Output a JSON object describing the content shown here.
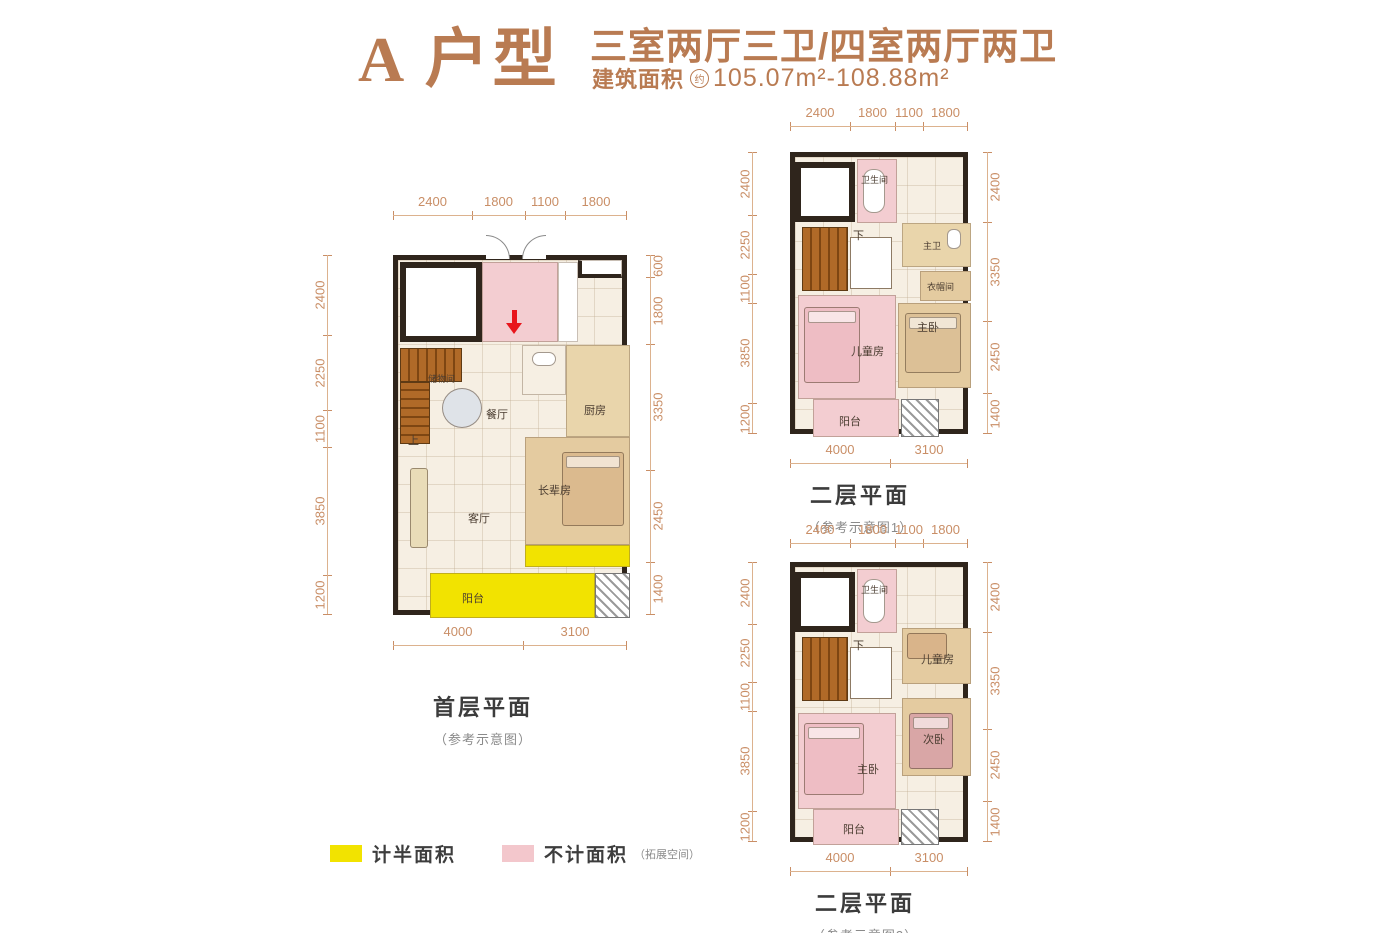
{
  "header": {
    "title": "A 户型",
    "subtitle": "三室两厅三卫/四室两厅两卫",
    "area_label": "建筑面积",
    "area_approx": "约",
    "area_value": "105.07m²-108.88m²"
  },
  "legend": {
    "half": {
      "label": "计半面积",
      "color": "#f2e300"
    },
    "none": {
      "label": "不计面积",
      "note": "（拓展空间）",
      "color": "#f3c7cc"
    }
  },
  "plans": [
    {
      "caption": "首层平面",
      "note": "（参考示意图）",
      "dims": {
        "top": [
          "2400",
          "1800",
          "1100",
          "1800"
        ],
        "left": [
          "2400",
          "2250",
          "1100",
          "3850",
          "1200"
        ],
        "right": [
          "600",
          "1800",
          "3350",
          "2450",
          "1400"
        ],
        "bottom": [
          "4000",
          "3100"
        ]
      },
      "rooms": {
        "storage": "储物间",
        "dining": "餐厅",
        "kitchen": "厨房",
        "living": "客厅",
        "elder": "长辈房",
        "balcony": "阳台",
        "stairs": "上"
      }
    },
    {
      "caption": "二层平面",
      "note": "（参考示意图1）",
      "dims": {
        "top": [
          "2400",
          "1800",
          "1100",
          "1800"
        ],
        "left": [
          "2400",
          "2250",
          "1100",
          "3850",
          "1200"
        ],
        "right": [
          "2400",
          "3350",
          "2450",
          "1400"
        ],
        "bottom": [
          "4000",
          "3100"
        ]
      },
      "rooms": {
        "bath": "卫生间",
        "master_bath": "主卫",
        "cloak": "衣帽间",
        "master": "主卧",
        "kids": "儿童房",
        "balcony": "阳台",
        "stairs": "下"
      }
    },
    {
      "caption": "二层平面",
      "note": "（参考示意图2）",
      "dims": {
        "top": [
          "2400",
          "1800",
          "1100",
          "1800"
        ],
        "left": [
          "2400",
          "2250",
          "1100",
          "3850",
          "1200"
        ],
        "right": [
          "2400",
          "3350",
          "2450",
          "1400"
        ],
        "bottom": [
          "4000",
          "3100"
        ]
      },
      "rooms": {
        "bath": "卫生间",
        "kids": "儿童房",
        "second": "次卧",
        "master": "主卧",
        "balcony": "阳台",
        "stairs": "下"
      }
    }
  ],
  "colors": {
    "accent": "#b97b52",
    "dimension": "#c98e66",
    "wall": "#2f251c",
    "half_area_yellow": "#f2e300",
    "extra_area_pink": "#f3c7cc"
  }
}
